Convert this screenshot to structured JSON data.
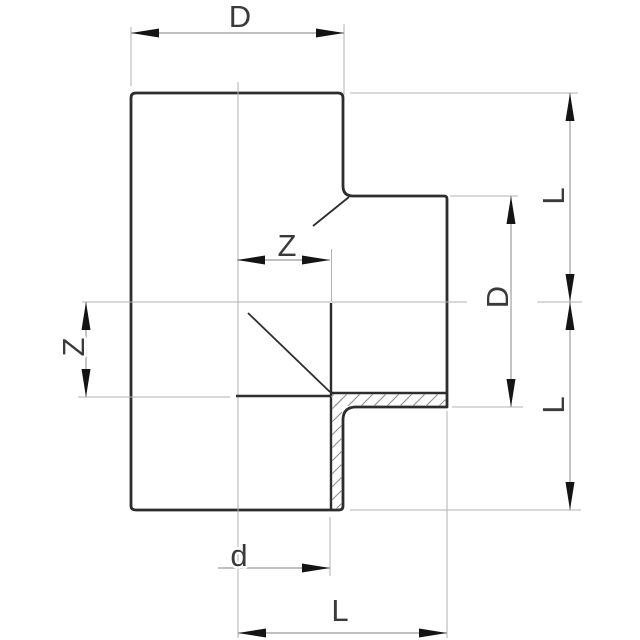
{
  "diagram": {
    "colors": {
      "background": "#ffffff",
      "outline": "#2d2d2d",
      "thin": "#b2b2b2",
      "dim": "#9b9b9b",
      "arrow": "#141414",
      "hatch": "#8f8f8f",
      "text": "#3a3a3a"
    },
    "labels": {
      "d_top": "D",
      "z_mid": "Z",
      "z_left": "Z",
      "d_right": "D",
      "l_right_upper": "L",
      "l_right_lower": "L",
      "d_bottom": "d",
      "l_bottom": "L"
    }
  }
}
